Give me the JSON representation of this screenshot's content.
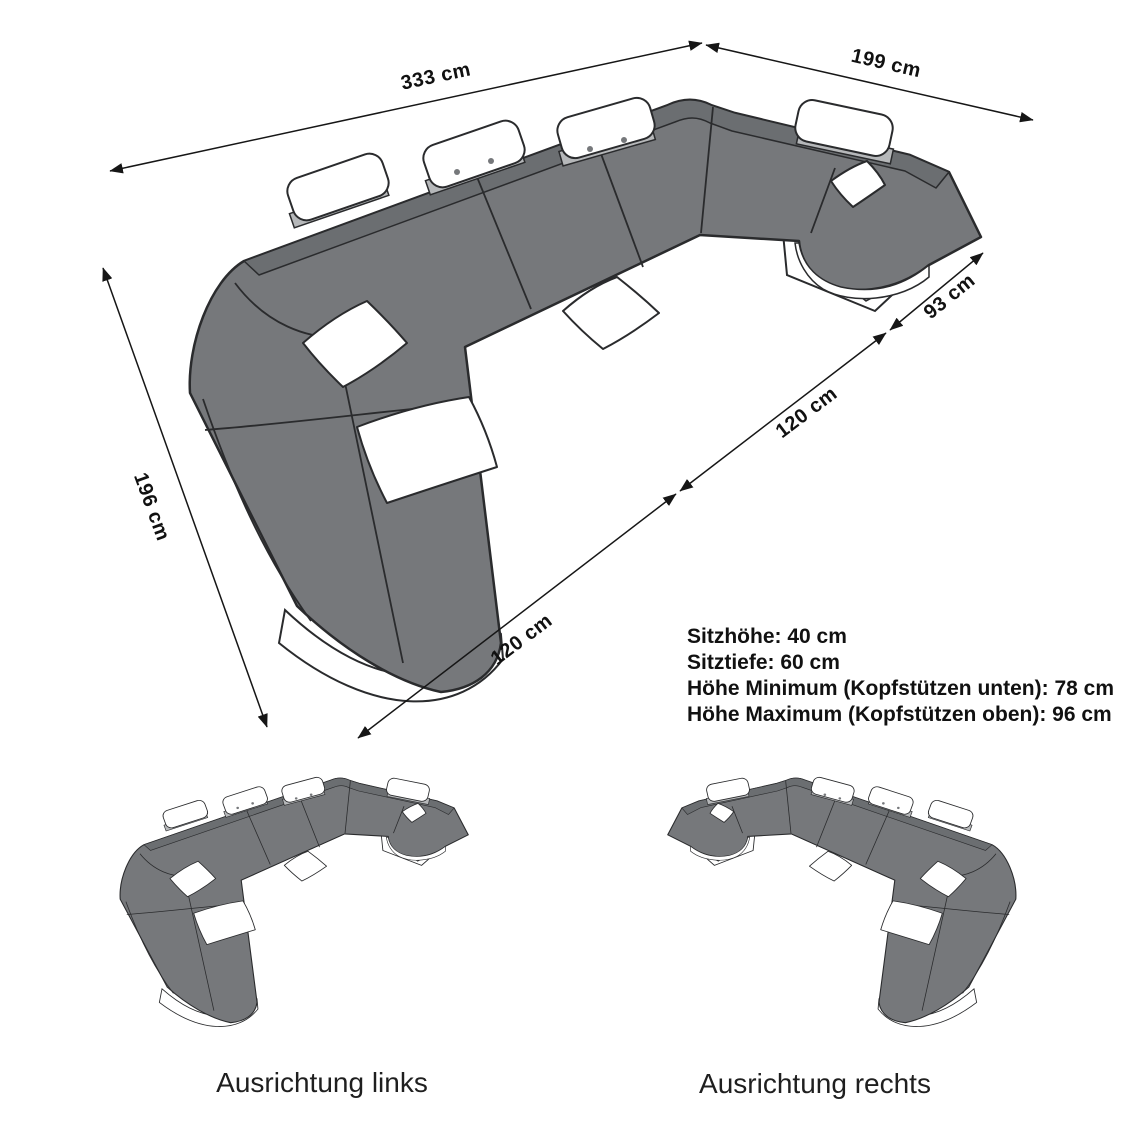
{
  "diagram": {
    "title_hidden": "",
    "product": "u-shaped-sectional-sofa-dimension-drawing",
    "dimensions": [
      {
        "id": "back-width",
        "label": "333 cm"
      },
      {
        "id": "right-depth",
        "label": "199 cm"
      },
      {
        "id": "left-depth",
        "label": "196 cm"
      },
      {
        "id": "chaise-length",
        "label": "120 cm"
      },
      {
        "id": "inner-width",
        "label": "120 cm"
      },
      {
        "id": "end-element-width",
        "label": "93 cm"
      }
    ],
    "specs": [
      "Sitzhöhe: 40 cm",
      "Sitztiefe: 60 cm",
      "Höhe Minimum (Kopfstützen unten): 78 cm",
      "Höhe Maximum (Kopfstützen oben): 96 cm"
    ],
    "variants": [
      {
        "id": "orientation-left",
        "label": "Ausrichtung links"
      },
      {
        "id": "orientation-right",
        "label": "Ausrichtung rechts"
      }
    ],
    "colors": {
      "background": "#ffffff",
      "sofa_body": "#76787b",
      "backrest_band": "#6b6e71",
      "outline": "#2a2b2d",
      "headrest_shelf": "#b6b8ba",
      "base_accent": "#aeb0b2",
      "text": "#111111"
    }
  }
}
